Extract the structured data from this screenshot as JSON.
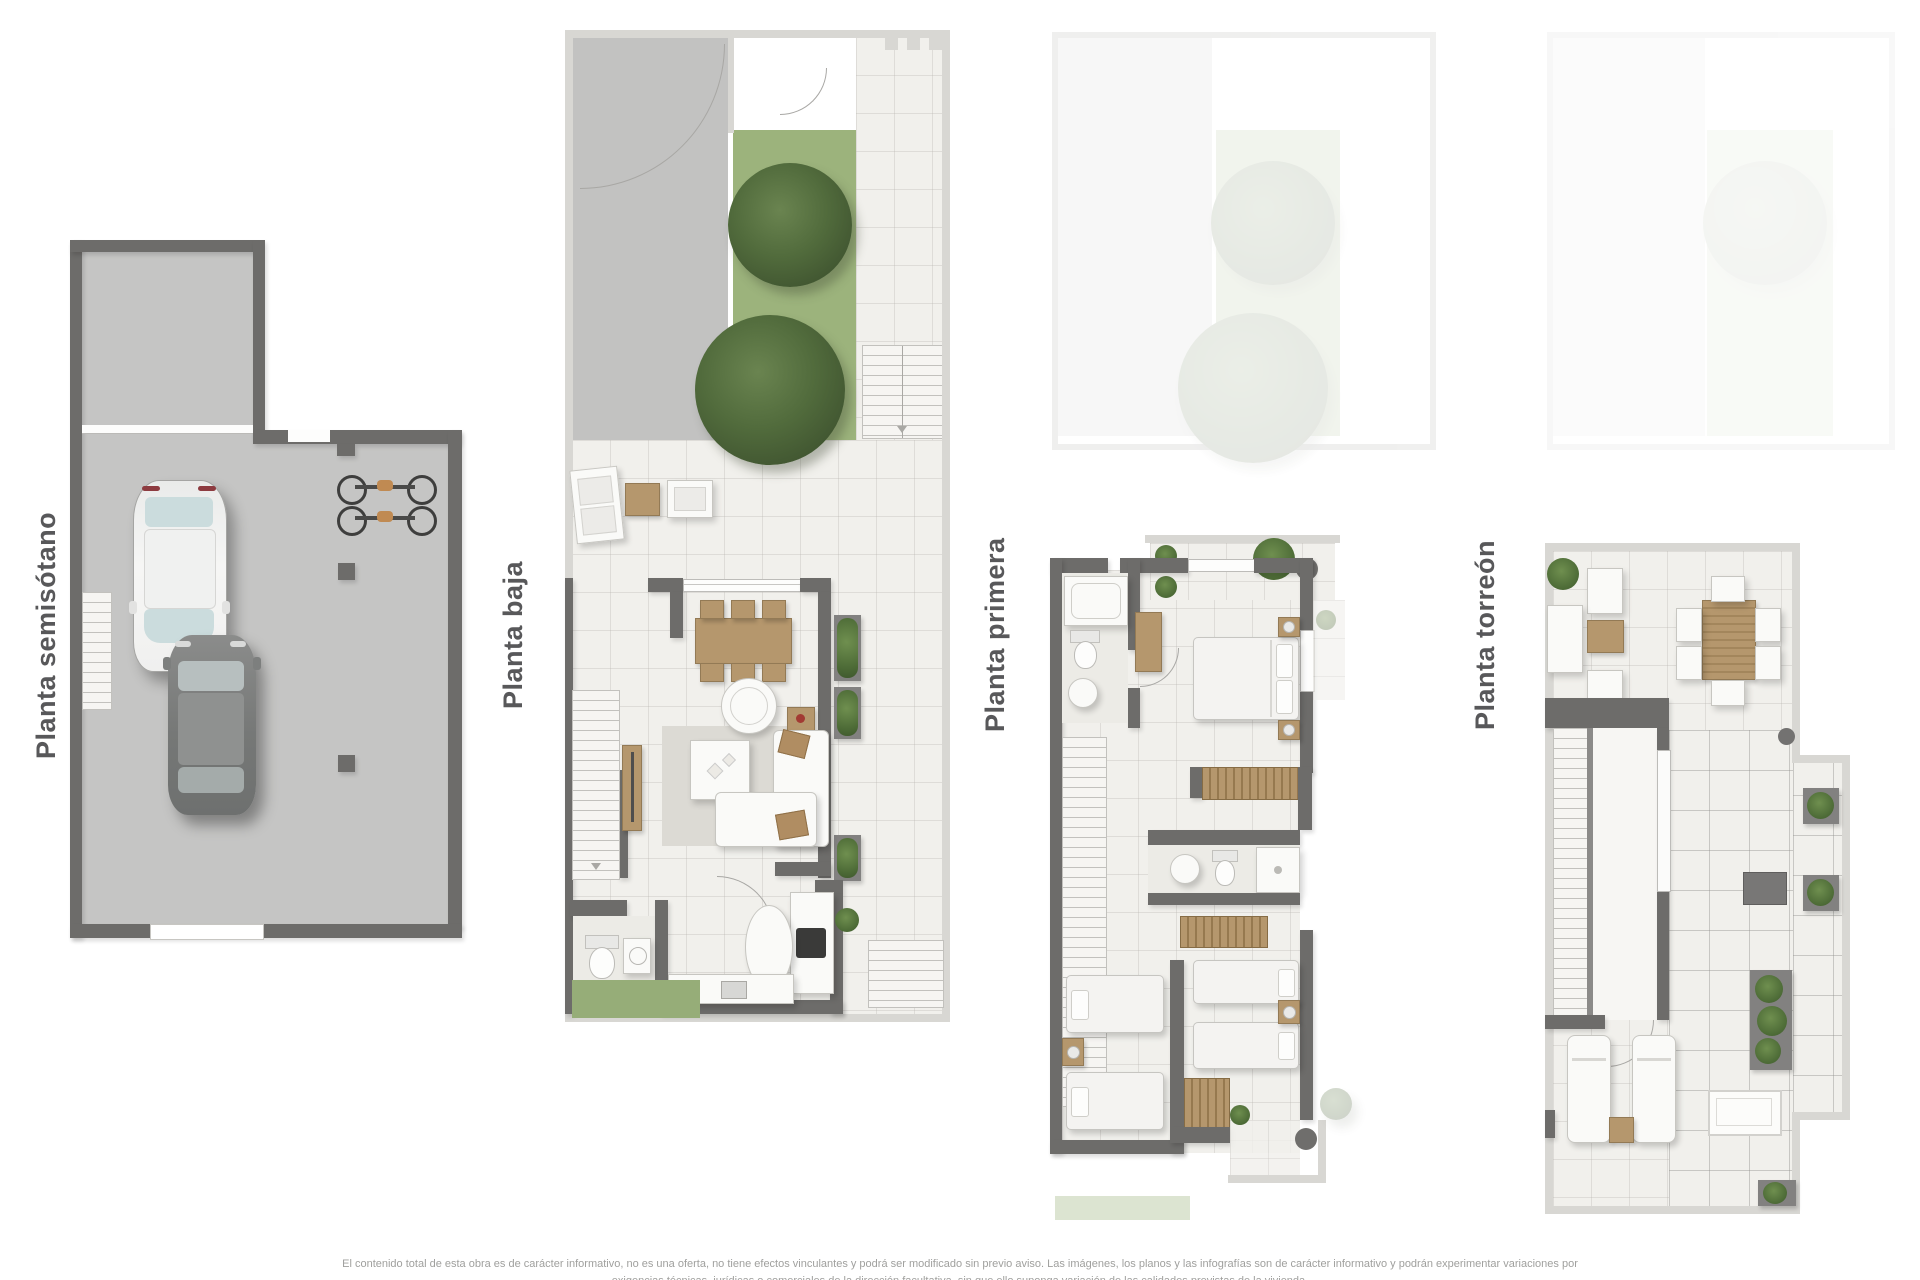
{
  "page": {
    "width": 1920,
    "height": 1280,
    "background": "#ffffff"
  },
  "plans": {
    "semisotano": {
      "label": "Planta semisótano"
    },
    "baja": {
      "label": "Planta baja"
    },
    "primera": {
      "label": "Planta primera"
    },
    "torreon": {
      "label": "Planta torreón"
    }
  },
  "footer": {
    "line1": "El contenido total de esta obra es de carácter informativo, no es una oferta, no tiene efectos vinculantes y podrá ser modificado sin previo aviso. Las imágenes, los planos y las infografías son de carácter informativo y podrán experimentar variaciones por",
    "line2_partial": "exigencias técnicas, jurídicas o comerciales de la dirección facultativa, sin que ello suponga variación de las calidades previstas de la vivienda."
  },
  "palette": {
    "wall_dark": "#6d6c6a",
    "wall_light": "#d8d7d3",
    "concrete_floor": "#c5c5c4",
    "interior_floor": "#f1f0ec",
    "grass": "#9cb37c",
    "tree": "#4c6337",
    "wood": "#b5976d",
    "furniture_white": "#fafaf8",
    "label_text": "#58585a",
    "disclaimer_text": "#a0a09e"
  }
}
